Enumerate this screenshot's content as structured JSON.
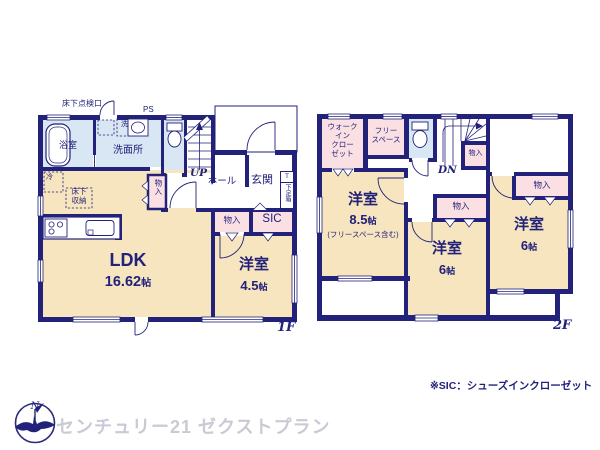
{
  "colors": {
    "wall": "#22227a",
    "room_beige": "#f7e5bf",
    "wet_blue": "#d9e6f4",
    "closet_pink": "#fadfe3",
    "text_navy": "#22227a",
    "footer_gray": "#c9cad5"
  },
  "floor1": {
    "label": "1F",
    "hatch": "床下点検口",
    "ps": "PS",
    "washer": "洗",
    "bath": "浴室",
    "washroom": "洗面所",
    "fridge": "冷",
    "floor_storage": "床下\n収納",
    "closet_small": "物入",
    "up": "UP",
    "hall": "ホール",
    "entrance": "玄関",
    "shoe_t": "T",
    "shoe_box": "下足箱",
    "closet_hall": "物入",
    "sic": "SIC",
    "ldk": {
      "name": "LDK",
      "size": "16.62",
      "unit": "帖"
    },
    "bedroom": {
      "name": "洋室",
      "size": "4.5",
      "unit": "帖"
    }
  },
  "floor2": {
    "label": "2F",
    "wic": "ウォーク\nイン\nクロー\nゼット",
    "free_space": "フリー\nスペース",
    "dn": "DN",
    "closet_a": "物入",
    "closet_b": "物入",
    "closet_c": "物入",
    "room_a": {
      "name": "洋室",
      "size": "8.5",
      "unit": "帖",
      "note": "(フリースペース含む)"
    },
    "room_b": {
      "name": "洋室",
      "size": "6",
      "unit": "帖"
    },
    "room_c": {
      "name": "洋室",
      "size": "6",
      "unit": "帖"
    }
  },
  "footer": {
    "logo_n": "N",
    "company": "センチュリー21 ゼクストプラン",
    "note": "※SIC：シューズインクローゼット"
  }
}
